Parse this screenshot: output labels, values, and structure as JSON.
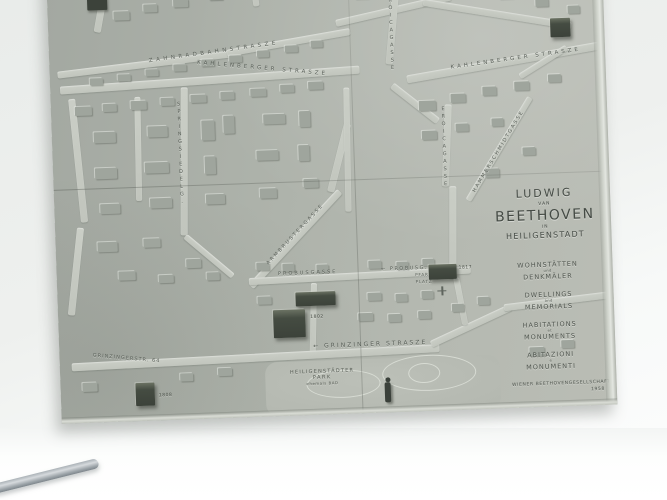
{
  "map": {
    "title": {
      "l1": "LUDWIG",
      "l2": "VAN",
      "l3": "BEETHOVEN",
      "l4": "IN",
      "l5": "HEILIGENSTADT"
    },
    "legend": [
      {
        "top": "WOHNSTÄTTEN",
        "mid": "und",
        "bottom": "DENKMÄLER"
      },
      {
        "top": "DWELLINGS",
        "mid": "and",
        "bottom": "MEMORIALS"
      },
      {
        "top": "HABITATIONS",
        "mid": "et",
        "bottom": "MONUMENTS"
      },
      {
        "top": "ABITAZIONI",
        "mid": "e",
        "bottom": "MONUMENTI"
      }
    ],
    "attribution": {
      "l1": "WIENER BEETHOVENGESELLSCHAFT",
      "l2": "1958"
    },
    "streets": {
      "zahnradbahn": "ZAHNRADBAHNSTRASZE",
      "kahlenberger_left": "KAHLENBERGER STRASZE",
      "kahlenberger_right": "KAHLENBERGER STRASZE",
      "eroicagasse_top": "EROICAGASSE",
      "eroicagasse_mid": "EROICAGASSE",
      "hammerschmidt": "HAMMERSCHMIDTGASSE",
      "springsiedel": "SPRINGSIEDELG.",
      "armbruster": "ARMBRUSTERGASSE",
      "probusgasse": "PROBUSGASSE",
      "probusg_short": "← PROBUSG.",
      "pfarrplatz_1": "PFARR",
      "pfarrplatz_2": "PLATZ",
      "grinzinger": "← GRINZINGER STRASZE",
      "grinzinger64": "GRINZINGERSTR. 64"
    },
    "park": {
      "l1": "HEILIGENSTÄDTER",
      "l2": "PARK",
      "l3": "ehemals BAD"
    },
    "markers": {
      "probushaus": "1802",
      "pfarrplatzhaus": "1817",
      "grinzingerhaus": "1808"
    }
  }
}
